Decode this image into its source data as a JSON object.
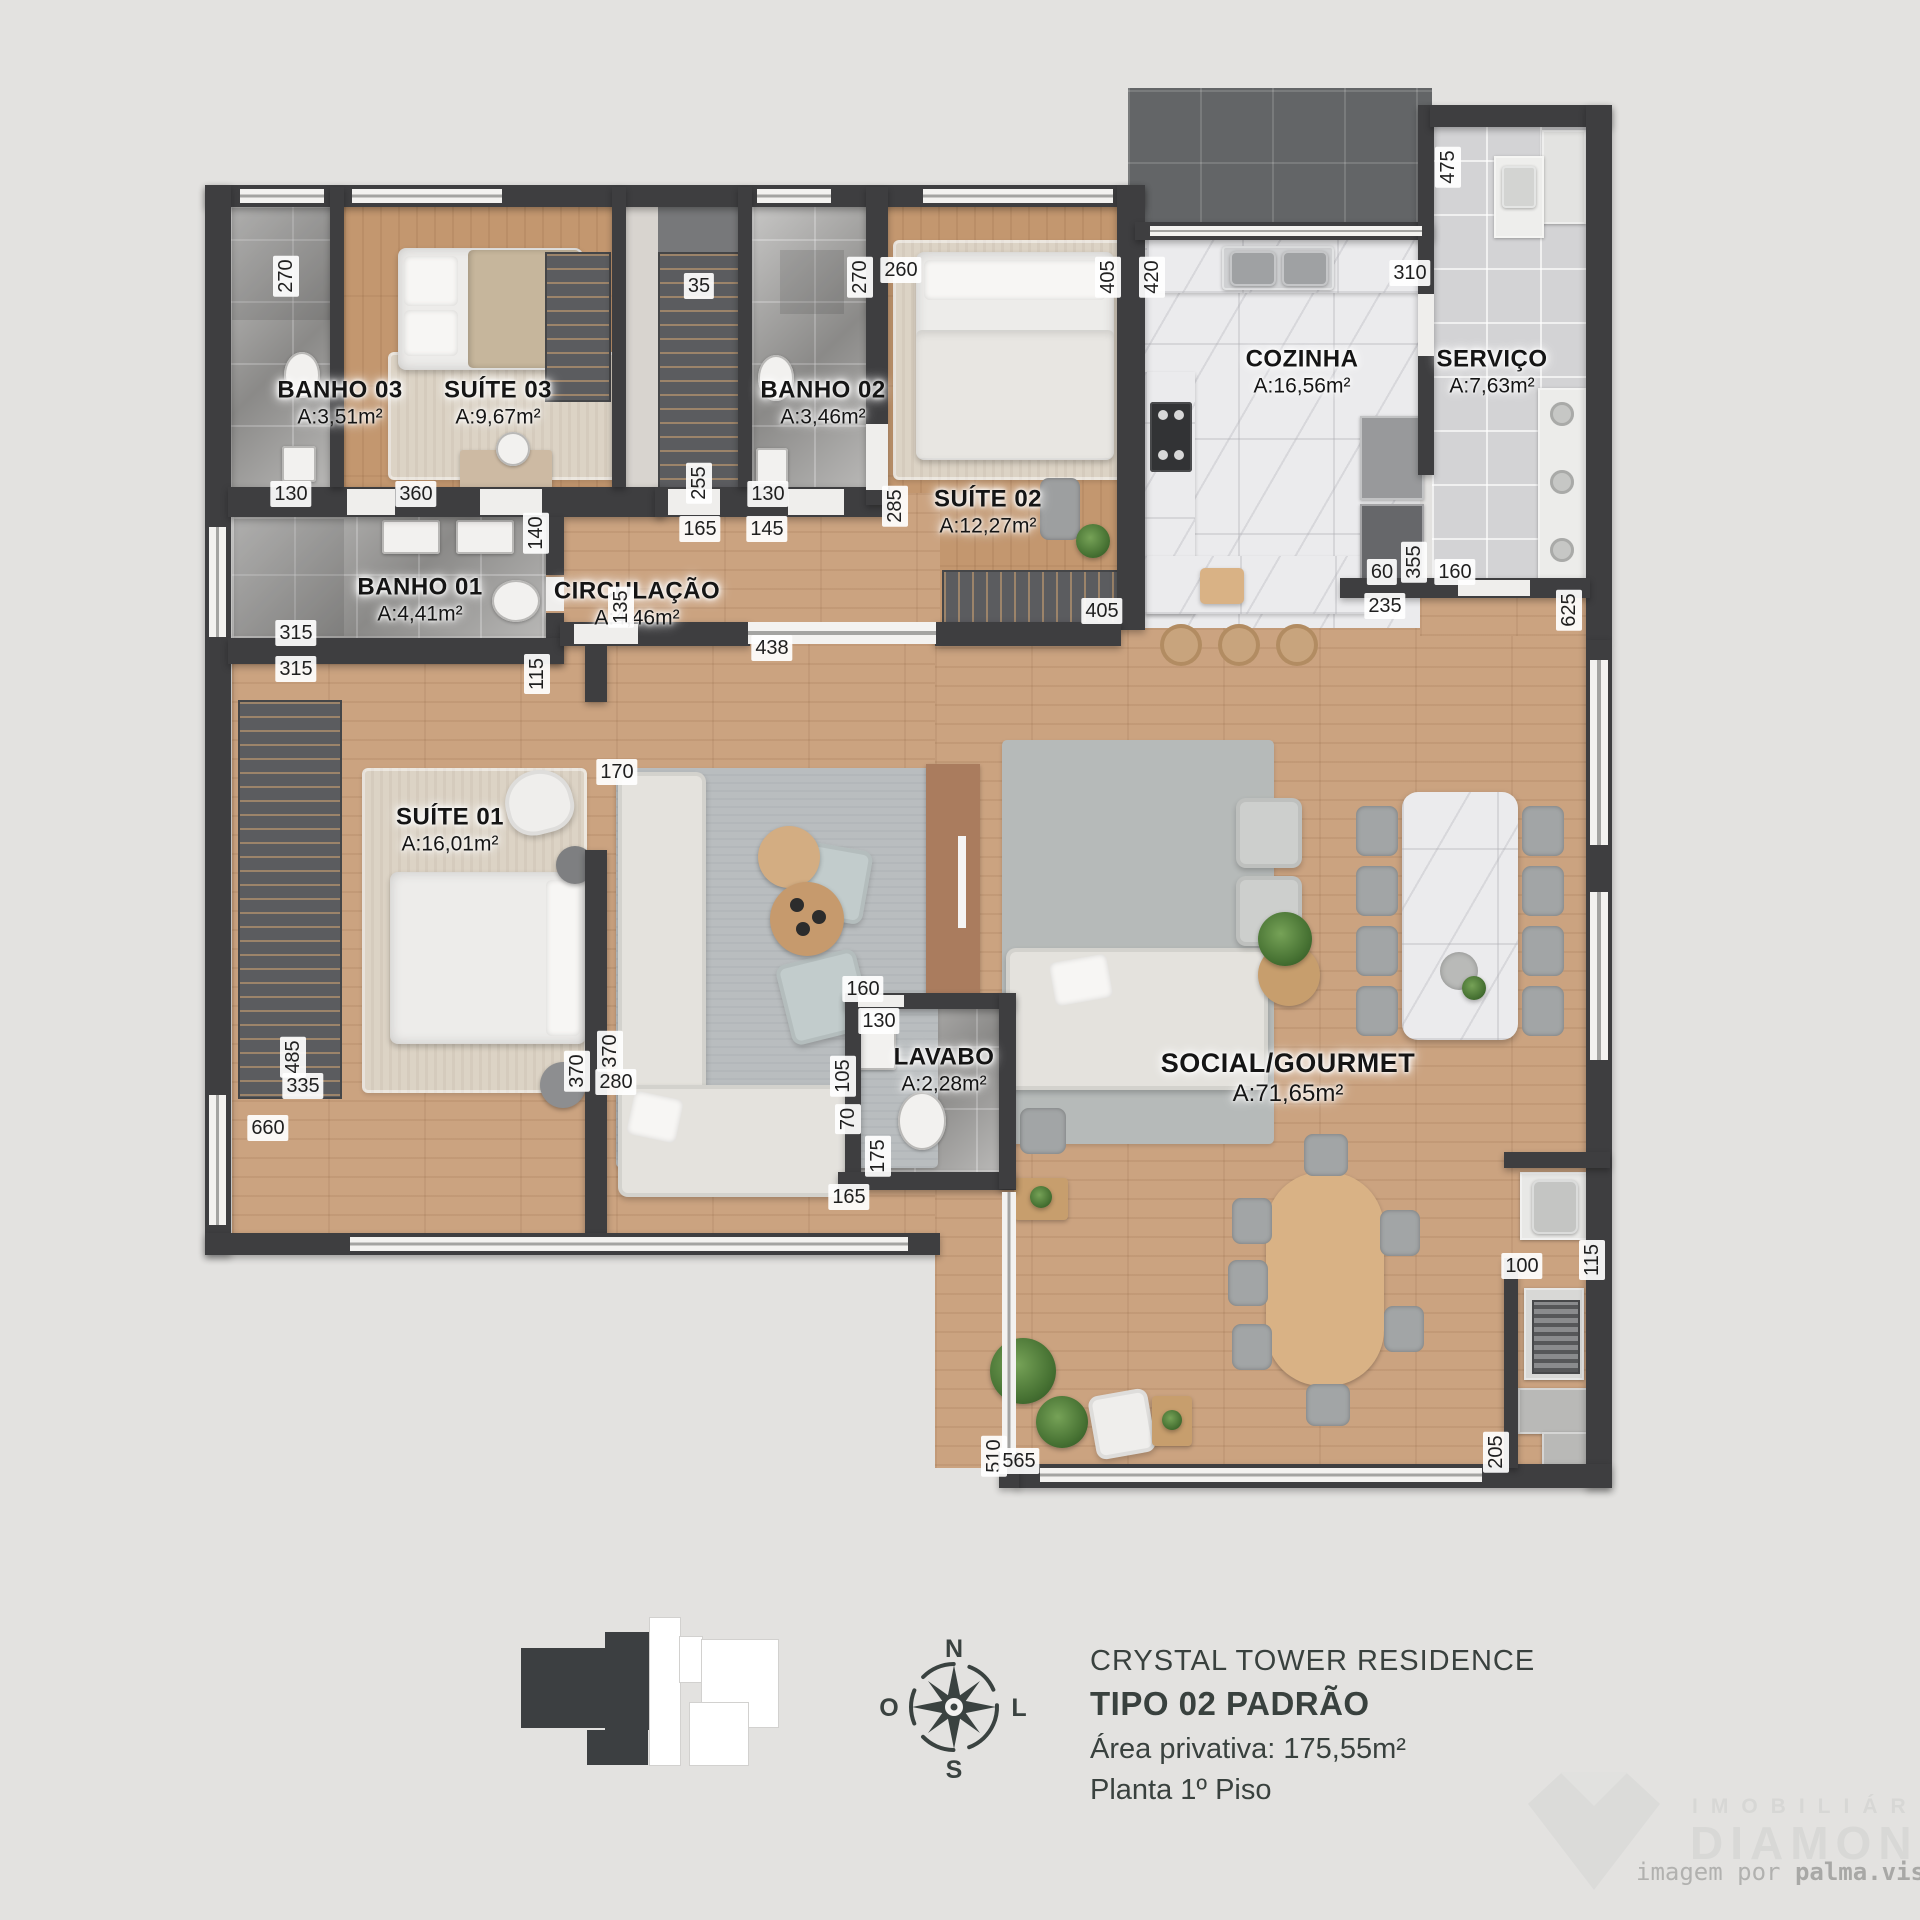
{
  "meta": {
    "colors": {
      "wall": "#3e3e40",
      "wood": "#cba380",
      "background": "#e3e2e0",
      "tile": "#a5a4a2"
    }
  },
  "rooms": [
    {
      "name": "BANHO 03",
      "area": "A:3,51m²",
      "x": 340,
      "y": 403
    },
    {
      "name": "SUÍTE 03",
      "area": "A:9,67m²",
      "x": 498,
      "y": 403
    },
    {
      "name": "BANHO 02",
      "area": "A:3,46m²",
      "x": 823,
      "y": 403
    },
    {
      "name": "SUÍTE 02",
      "area": "A:12,27m²",
      "x": 988,
      "y": 512
    },
    {
      "name": "COZINHA",
      "area": "A:16,56m²",
      "x": 1302,
      "y": 372
    },
    {
      "name": "SERVIÇO",
      "area": "A:7,63m²",
      "x": 1492,
      "y": 372
    },
    {
      "name": "BANHO 01",
      "area": "A:4,41m²",
      "x": 420,
      "y": 600
    },
    {
      "name": "CIRCULAÇÃO",
      "area": "A:4,46m²",
      "x": 637,
      "y": 604
    },
    {
      "name": "SUÍTE 01",
      "area": "A:16,01m²",
      "x": 450,
      "y": 830
    },
    {
      "name": "LAVABO",
      "area": "A:2,28m²",
      "x": 944,
      "y": 1070
    },
    {
      "name": "SOCIAL/GOURMET",
      "area": "A:71,65m²",
      "x": 1288,
      "y": 1078,
      "cls": "big"
    }
  ],
  "dims": [
    {
      "v": "270",
      "x": 286,
      "y": 276,
      "o": "v"
    },
    {
      "v": "130",
      "x": 291,
      "y": 494,
      "o": "h"
    },
    {
      "v": "360",
      "x": 416,
      "y": 494,
      "o": "h"
    },
    {
      "v": "35",
      "x": 699,
      "y": 286,
      "o": "h"
    },
    {
      "v": "255",
      "x": 699,
      "y": 483,
      "o": "v"
    },
    {
      "v": "165",
      "x": 700,
      "y": 529,
      "o": "h"
    },
    {
      "v": "145",
      "x": 767,
      "y": 529,
      "o": "h"
    },
    {
      "v": "130",
      "x": 768,
      "y": 494,
      "o": "h"
    },
    {
      "v": "270",
      "x": 860,
      "y": 277,
      "o": "v"
    },
    {
      "v": "260",
      "x": 901,
      "y": 270,
      "o": "h"
    },
    {
      "v": "285",
      "x": 895,
      "y": 506,
      "o": "v"
    },
    {
      "v": "405",
      "x": 1108,
      "y": 277,
      "o": "v"
    },
    {
      "v": "420",
      "x": 1152,
      "y": 277,
      "o": "v"
    },
    {
      "v": "310",
      "x": 1410,
      "y": 273,
      "o": "h"
    },
    {
      "v": "475",
      "x": 1448,
      "y": 167,
      "o": "v"
    },
    {
      "v": "140",
      "x": 536,
      "y": 533,
      "o": "v"
    },
    {
      "v": "315",
      "x": 296,
      "y": 633,
      "o": "h"
    },
    {
      "v": "315",
      "x": 296,
      "y": 669,
      "o": "h"
    },
    {
      "v": "115",
      "x": 537,
      "y": 674,
      "o": "v"
    },
    {
      "v": "438",
      "x": 772,
      "y": 648,
      "o": "h"
    },
    {
      "v": "405",
      "x": 1102,
      "y": 611,
      "o": "h"
    },
    {
      "v": "60",
      "x": 1382,
      "y": 572,
      "o": "h"
    },
    {
      "v": "355",
      "x": 1414,
      "y": 562,
      "o": "v"
    },
    {
      "v": "160",
      "x": 1455,
      "y": 572,
      "o": "h"
    },
    {
      "v": "235",
      "x": 1385,
      "y": 606,
      "o": "h"
    },
    {
      "v": "625",
      "x": 1569,
      "y": 610,
      "o": "v"
    },
    {
      "v": "135",
      "x": 621,
      "y": 607,
      "o": "v"
    },
    {
      "v": "170",
      "x": 617,
      "y": 772,
      "o": "h"
    },
    {
      "v": "485",
      "x": 293,
      "y": 1057,
      "o": "v"
    },
    {
      "v": "335",
      "x": 303,
      "y": 1086,
      "o": "h"
    },
    {
      "v": "660",
      "x": 268,
      "y": 1128,
      "o": "h"
    },
    {
      "v": "370",
      "x": 577,
      "y": 1071,
      "o": "v"
    },
    {
      "v": "370",
      "x": 610,
      "y": 1051,
      "o": "v"
    },
    {
      "v": "280",
      "x": 616,
      "y": 1082,
      "o": "h"
    },
    {
      "v": "160",
      "x": 863,
      "y": 989,
      "o": "h"
    },
    {
      "v": "130",
      "x": 879,
      "y": 1021,
      "o": "h"
    },
    {
      "v": "105",
      "x": 843,
      "y": 1076,
      "o": "v"
    },
    {
      "v": "70",
      "x": 848,
      "y": 1119,
      "o": "v"
    },
    {
      "v": "175",
      "x": 878,
      "y": 1156,
      "o": "v"
    },
    {
      "v": "165",
      "x": 849,
      "y": 1197,
      "o": "h"
    },
    {
      "v": "510",
      "x": 994,
      "y": 1456,
      "o": "v"
    },
    {
      "v": "565",
      "x": 1019,
      "y": 1461,
      "o": "h"
    },
    {
      "v": "100",
      "x": 1522,
      "y": 1266,
      "o": "h"
    },
    {
      "v": "115",
      "x": 1592,
      "y": 1260,
      "o": "v"
    },
    {
      "v": "205",
      "x": 1496,
      "y": 1452,
      "o": "v"
    }
  ],
  "footer": {
    "project": "CRYSTAL TOWER RESIDENCE",
    "type_label": "TIPO 02 PADRÃO",
    "private_area": "Área privativa: 175,55m²",
    "floor_label": "Planta 1º Piso"
  },
  "compass": {
    "n": "N",
    "s": "S",
    "e": "L",
    "w": "O"
  },
  "watermark": {
    "brand_top": "IMOBILIÁRIA",
    "brand": "DIAMOND",
    "credit_prefix": "imagem por ",
    "credit_brand": "palma.vis"
  }
}
